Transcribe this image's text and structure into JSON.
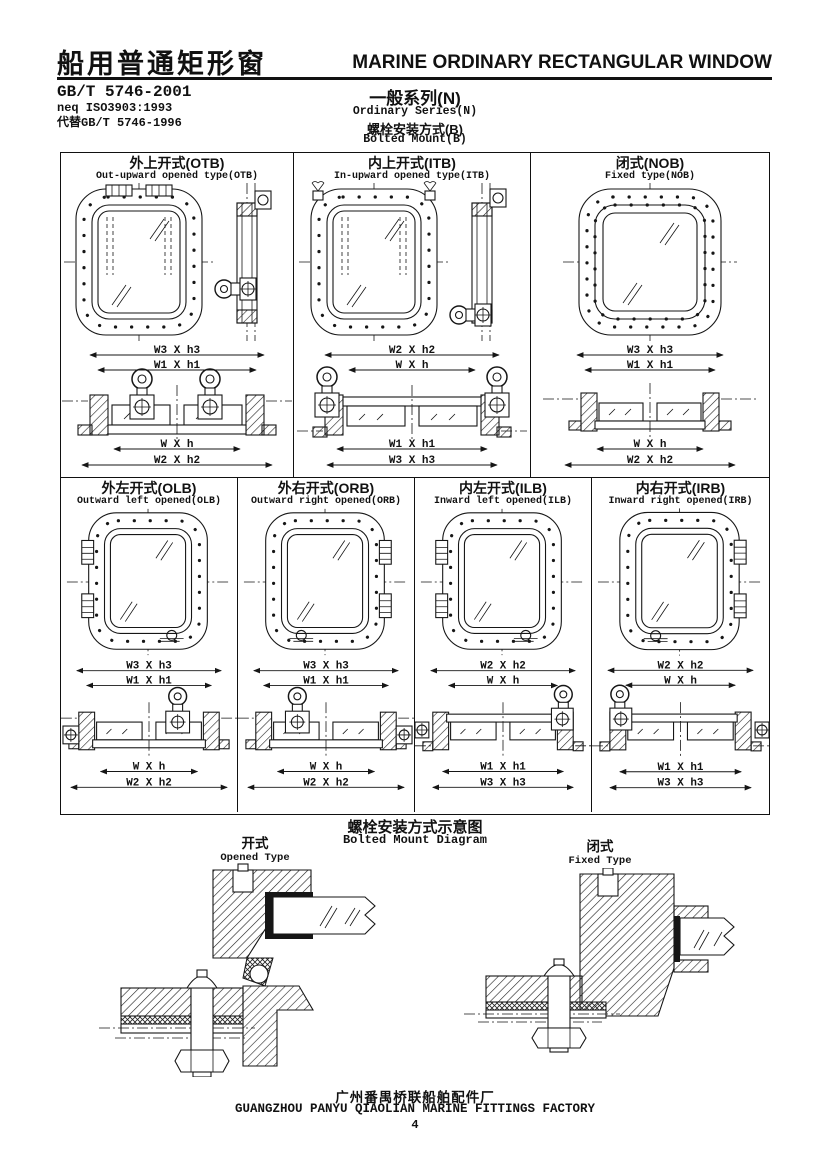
{
  "header": {
    "title_zh": "船用普通矩形窗",
    "title_en": "MARINE ORDINARY RECTANGULAR WINDOW",
    "standard_code": "GB/T 5746-2001",
    "standard_equiv": "neq ISO3903:1993",
    "standard_replaces": "代替GB/T 5746-1996",
    "series_zh": "一般系列(N)",
    "series_en": "Ordinary Series(N)",
    "mount_zh": "螺栓安装方式(B)",
    "mount_en": "Bolted Mount(B)"
  },
  "panels": [
    {
      "code": "OTB",
      "title_zh": "外上开式(OTB)",
      "title_en": "Out-upward opened type(OTB)",
      "dims_top": [
        "W3 X h3",
        "W1 X h1"
      ],
      "dims_bottom": [
        "W X h",
        "W2 X h2"
      ]
    },
    {
      "code": "ITB",
      "title_zh": "内上开式(ITB)",
      "title_en": "In-upward opened type(ITB)",
      "dims_top": [
        "W2 X h2",
        "W X h"
      ],
      "dims_bottom": [
        "W1 X h1",
        "W3 X h3"
      ]
    },
    {
      "code": "NOB",
      "title_zh": "闭式(NOB)",
      "title_en": "Fixed type(NOB)",
      "dims_top": [
        "W3 X h3",
        "W1 X h1"
      ],
      "dims_bottom": [
        "W X h",
        "W2 X h2"
      ]
    },
    {
      "code": "OLB",
      "title_zh": "外左开式(OLB)",
      "title_en": "Outward left opened(OLB)",
      "dims_top": [
        "W3 X h3",
        "W1 X h1"
      ],
      "dims_bottom": [
        "W X h",
        "W2 X h2"
      ]
    },
    {
      "code": "ORB",
      "title_zh": "外右开式(ORB)",
      "title_en": "Outward right opened(ORB)",
      "dims_top": [
        "W3 X h3",
        "W1 X h1"
      ],
      "dims_bottom": [
        "W X h",
        "W2 X h2"
      ]
    },
    {
      "code": "ILB",
      "title_zh": "内左开式(ILB)",
      "title_en": "Inward left opened(ILB)",
      "dims_top": [
        "W2 X h2",
        "W X h"
      ],
      "dims_bottom": [
        "W1 X h1",
        "W3 X h3"
      ]
    },
    {
      "code": "IRB",
      "title_zh": "内右开式(IRB)",
      "title_en": "Inward right opened(IRB)",
      "dims_top": [
        "W2 X h2",
        "W X h"
      ],
      "dims_bottom": [
        "W1 X h1",
        "W3 X h3"
      ]
    }
  ],
  "mount_diagram": {
    "title_zh": "螺栓安装方式示意图",
    "title_en": "Bolted Mount Diagram",
    "left_label_zh": "开式",
    "left_label_en": "Opened Type",
    "right_label_zh": "闭式",
    "right_label_en": "Fixed Type"
  },
  "footer": {
    "factory_zh": "广州番禺桥联船舶配件厂",
    "factory_en": "GUANGZHOU PANYU QIAOLIAN MARINE FITTINGS FACTORY",
    "page_number": "4"
  }
}
